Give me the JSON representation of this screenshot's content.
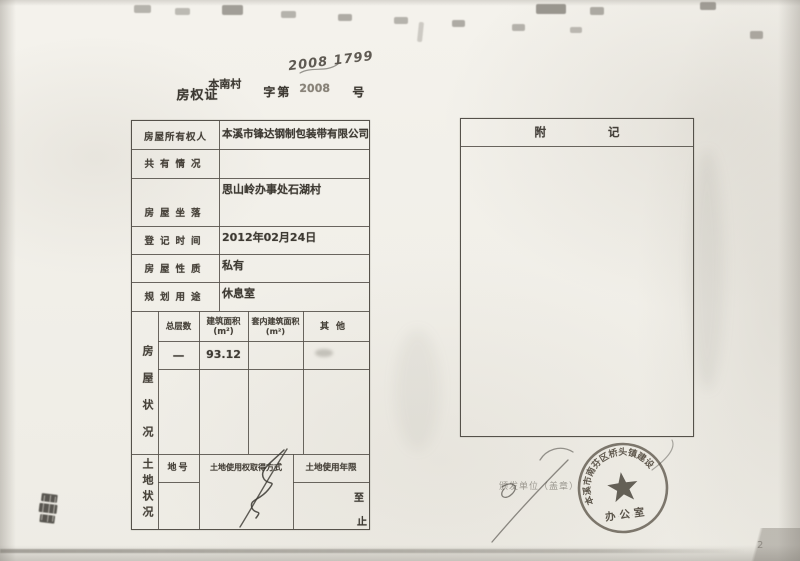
{
  "page": {
    "page_number": "2"
  },
  "header": {
    "cert_type": "房权证",
    "cert_region": "本南村",
    "zi_di": "字第",
    "number_printed": "2008",
    "number_suffix": "号",
    "number_handwritten": "2008 1799"
  },
  "main_table": {
    "rows": [
      {
        "label": "房屋所有权人",
        "value": "本溪市锋达钢制包装带有限公司"
      },
      {
        "label": "共有情况",
        "value": ""
      },
      {
        "label": "房屋坐落",
        "value": "思山岭办事处石湖村"
      },
      {
        "label": "登记时间",
        "value": "2012年02月24日"
      },
      {
        "label": "房屋性质",
        "value": "私有"
      },
      {
        "label": "规划用途",
        "value": "休息室"
      }
    ],
    "house_section": {
      "side_label": "房屋状况",
      "columns": [
        "总层数",
        "建筑面积\n(m²)",
        "套内建筑面积\n(m²)",
        "其他"
      ],
      "values": [
        "一",
        "93.12",
        "",
        ""
      ]
    },
    "land_section": {
      "side_label": "土地状况",
      "columns": [
        "地号",
        "土地使用权取得方式",
        "土地使用年限"
      ],
      "term_from": "至",
      "term_to": "止"
    }
  },
  "notes_box": {
    "title": "附记"
  },
  "stamp": {
    "ring_text": "本溪市南芬区桥头镇建设",
    "inner_text": "办公室",
    "bottom_marks": "· · · · · · ·",
    "issuer_label": "颁发单位（盖章）"
  }
}
